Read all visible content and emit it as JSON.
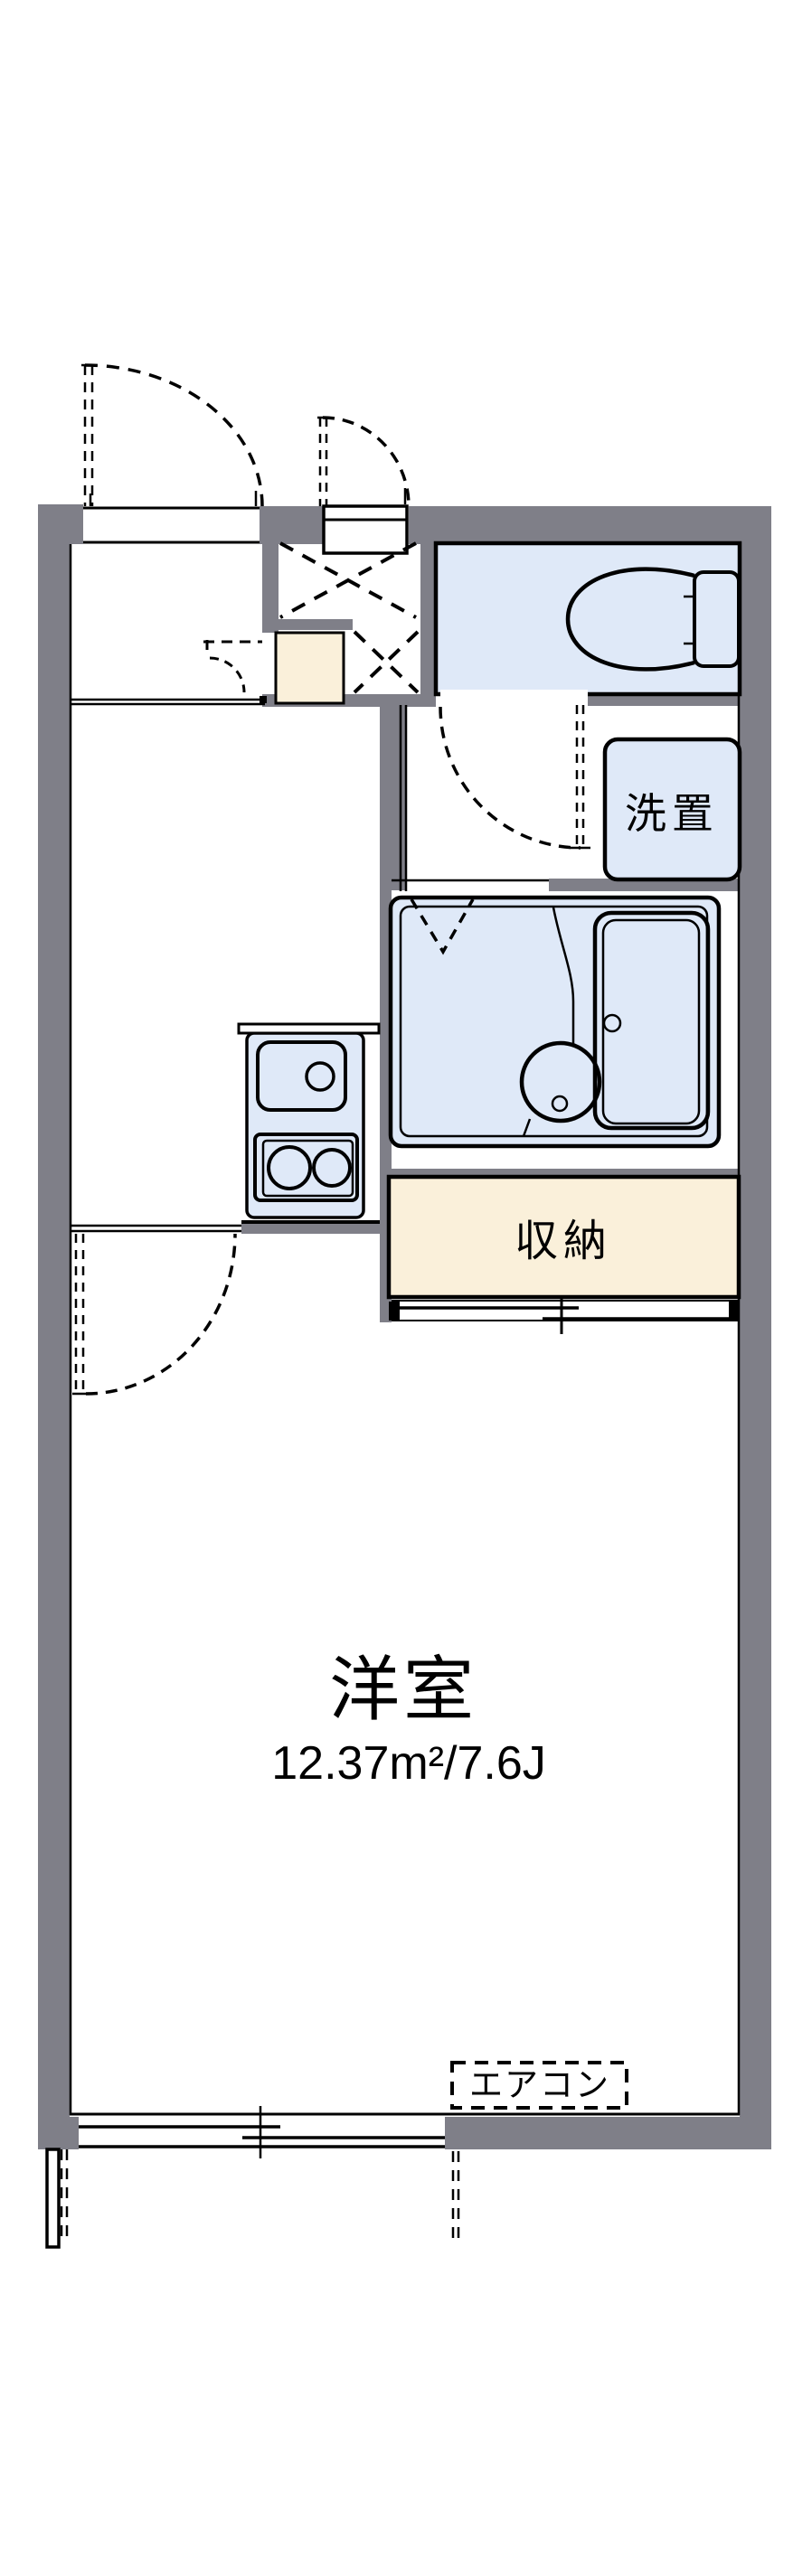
{
  "floor_plan": {
    "labels": {
      "western_room_name": "洋室",
      "western_room_area": "12.37m²/7.6J",
      "storage": "収納",
      "washing_machine": "洗置",
      "air_conditioner": "エアコン"
    },
    "colors": {
      "wall": "#7f7f88",
      "fixture_fill": "#dfe9f8",
      "storage_fill": "#faf0da",
      "line": "#000000",
      "background": "#ffffff"
    }
  }
}
